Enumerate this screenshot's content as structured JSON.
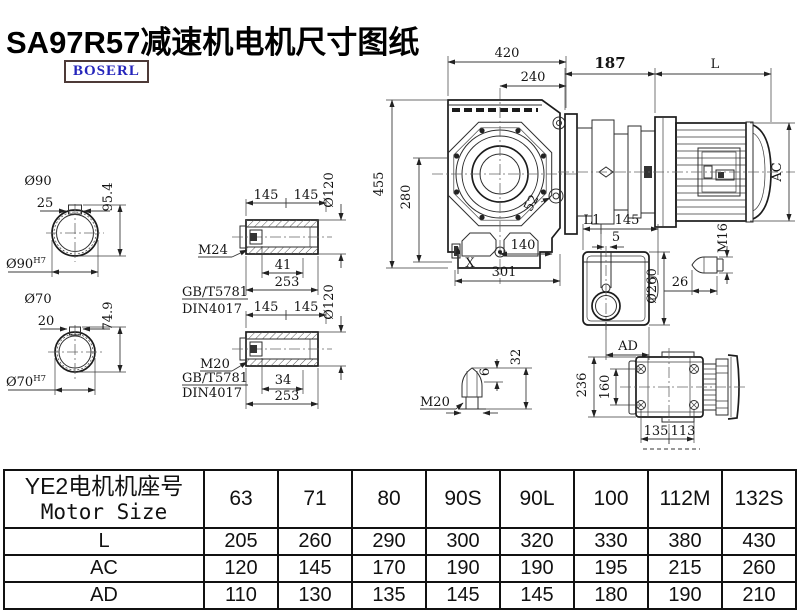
{
  "page": {
    "title": "SA97R57减速机电机尺寸图纸",
    "logo": "BOSERL"
  },
  "drawing": {
    "shaft_section_90": {
      "dia": "Ø90",
      "key_width": "25",
      "key_height": "95.4",
      "bore": "Ø90",
      "bore_tol": "H7"
    },
    "shaft_section_70": {
      "dia": "Ø70",
      "key_width": "20",
      "key_height": "74.9",
      "bore": "Ø70",
      "bore_tol": "H7"
    },
    "hollow_shaft_m24": {
      "half_a": "145",
      "half_b": "145",
      "dia": "Ø120",
      "thread": "M24",
      "std1": "GB/T5781",
      "std2": "DIN4017",
      "bolt_len": "41",
      "total_len": "253"
    },
    "hollow_shaft_m20": {
      "half_a": "145",
      "half_b": "145",
      "dia": "Ø120",
      "thread": "M20",
      "std1": "GB/T5781",
      "std2": "DIN4017",
      "bolt_len": "34",
      "total_len": "253"
    },
    "front_view": {
      "width": "420",
      "width_half": "240",
      "height": "455",
      "height_inner": "280",
      "hole_offset": "52",
      "bottom_half": "140",
      "bottom_width": "301",
      "mark_x": "X"
    },
    "motor_view": {
      "adapter_len": "187",
      "motor_len": "L",
      "motor_dia": "AC"
    },
    "side_view": {
      "l1": "L1",
      "flange_len": "145",
      "gap": "5",
      "dia": "Ø260",
      "ad": "AD"
    },
    "bolt_m16": {
      "thread": "M16",
      "length": "26"
    },
    "bolt_m20": {
      "thread": "M20",
      "tip": "6",
      "length": "32"
    },
    "top_view": {
      "height": "236",
      "hole_span": "160",
      "left_span": "135",
      "right_span": "113"
    }
  },
  "table": {
    "header": {
      "line1": "YE2电机机座号",
      "line2": "Motor Size"
    },
    "sizes": [
      "63",
      "71",
      "80",
      "90S",
      "90L",
      "100",
      "112M",
      "132S"
    ],
    "rows": [
      {
        "label": "L",
        "values": [
          "205",
          "260",
          "290",
          "300",
          "320",
          "330",
          "380",
          "430"
        ]
      },
      {
        "label": "AC",
        "values": [
          "120",
          "145",
          "170",
          "190",
          "190",
          "195",
          "215",
          "260"
        ]
      },
      {
        "label": "AD",
        "values": [
          "110",
          "130",
          "135",
          "145",
          "145",
          "180",
          "190",
          "210"
        ]
      }
    ]
  }
}
